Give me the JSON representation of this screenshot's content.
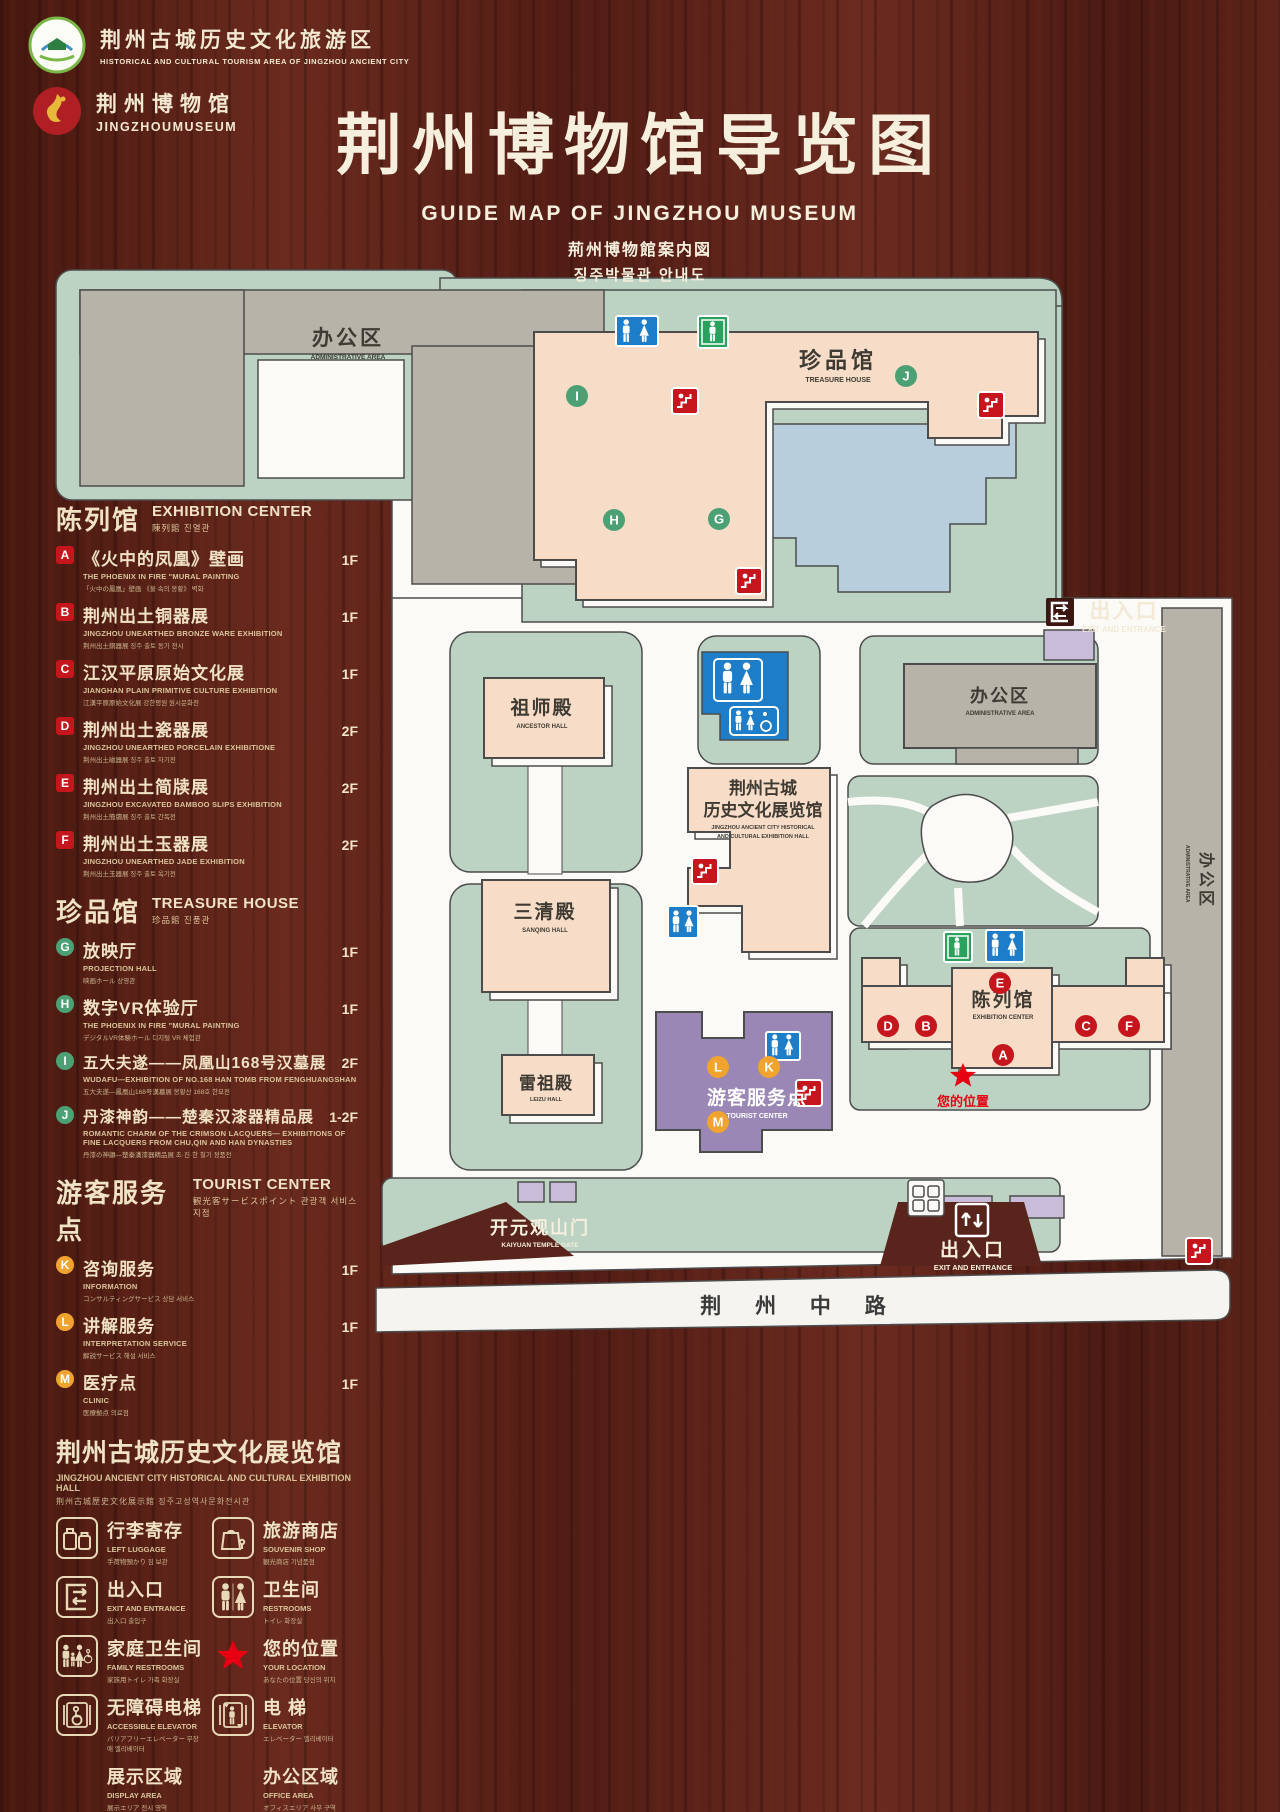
{
  "header": {
    "logo1": {
      "line1": "荆州古城历史文化旅游区",
      "line2": "HISTORICAL AND CULTURAL TOURISM AREA OF JINGZHOU ANCIENT CITY"
    },
    "logo2": {
      "line1": "荆州博物馆",
      "line2": "JINGZHOUMUSEUM"
    },
    "title": "荆州博物馆导览图",
    "subtitle_en": "GUIDE MAP OF JINGZHOU MUSEUM",
    "subtitle_ja": "荊州博物館案内図",
    "subtitle_ko": "징주박물관 안내도"
  },
  "sections": {
    "exhibition": {
      "title_zh": "陈列馆",
      "title_en": "EXHIBITION CENTER",
      "subtitle": "陳列館  진열관",
      "items": [
        {
          "key": "A",
          "zh": "《火中的凤凰》壁画",
          "en": "THE PHOENIX IN FIRE \"MURAL PAINTING",
          "sub": "「火中の鳳凰」壁画 《불 속의 봉황》 벽화",
          "floor": "1F"
        },
        {
          "key": "B",
          "zh": "荆州出土铜器展",
          "en": "JINGZHOU UNEARTHED BRONZE WARE EXHIBITION",
          "sub": "荆州出土銅器展  징주 출토 동기 전시",
          "floor": "1F"
        },
        {
          "key": "C",
          "zh": "江汉平原原始文化展",
          "en": "JIANGHAN PLAIN PRIMITIVE CULTURE EXHIBITION",
          "sub": "江漢平原原始文化展  강한평원 원시문화전",
          "floor": "1F"
        },
        {
          "key": "D",
          "zh": "荆州出土瓷器展",
          "en": "JINGZHOU UNEARTHED PORCELAIN EXHIBITIONE",
          "sub": "荆州出土磁器展  징주 출토 자기전",
          "floor": "2F"
        },
        {
          "key": "E",
          "zh": "荆州出土简牍展",
          "en": "JINGZHOU EXCAVATED BAMBOO SLIPS EXHIBITION",
          "sub": "荆州出土簡牘展  징주 출토 간독전",
          "floor": "2F"
        },
        {
          "key": "F",
          "zh": "荆州出土玉器展",
          "en": "JINGZHOU UNEARTHED JADE EXHIBITION",
          "sub": "荆州出土玉器展  징주 출토 옥기전",
          "floor": "2F"
        }
      ]
    },
    "treasure": {
      "title_zh": "珍品馆",
      "title_en": "TREASURE HOUSE",
      "subtitle": "珍品館  진품관",
      "items": [
        {
          "key": "G",
          "zh": "放映厅",
          "en": "PROJECTION HALL",
          "sub": "映画ホール  상영관",
          "floor": "1F"
        },
        {
          "key": "H",
          "zh": "数字VR体验厅",
          "en": "THE PHOENIX IN FIRE \"MURAL PAINTING",
          "sub": "デジタルVR体験ホール  디지털 VR 체험관",
          "floor": "1F"
        },
        {
          "key": "I",
          "zh": "五大夫遂——凤凰山168号汉墓展",
          "en": "WUDAFU—EXHIBITION OF NO.168 HAN TOMB FROM FENGHUANGSHAN",
          "sub": "五大夫遂—鳳凰山168号漢墓展  봉황산 168호 한묘전",
          "floor": "2F"
        },
        {
          "key": "J",
          "zh": "丹漆神韵——楚秦汉漆器精品展",
          "en": "ROMANTIC CHARM OF THE CRIMSON LACQUERS— EXHIBITIONS OF FINE LACQUERS FROM CHU,QIN AND HAN DYNASTIES",
          "sub": "丹漆の神韻—楚秦漢漆器精品展  초·진·한 칠기 정품전",
          "floor": "1-2F"
        }
      ]
    },
    "tourist": {
      "title_zh": "游客服务点",
      "title_en": "TOURIST CENTER",
      "subtitle": "観光客サービスポイント  관광객 서비스 지점",
      "items": [
        {
          "key": "K",
          "zh": "咨询服务",
          "en": "INFORMATION",
          "sub": "コンサルティングサービス  상담 서비스",
          "floor": "1F"
        },
        {
          "key": "L",
          "zh": "讲解服务",
          "en": "INTERPRETATION SERVICE",
          "sub": "解説サービス  해설 서비스",
          "floor": "1F"
        },
        {
          "key": "M",
          "zh": "医疗点",
          "en": "CLINIC",
          "sub": "医療拠点  의료점",
          "floor": "1F"
        }
      ]
    },
    "hall_note": {
      "zh": "荆州古城历史文化展览馆",
      "en": "JINGZHOU ANCIENT CITY HISTORICAL AND CULTURAL EXHIBITION HALL",
      "sub": "荆州古城歴史文化展示館  징주고성역사문화전시관"
    }
  },
  "legend": [
    {
      "zh": "行李寄存",
      "en": "LEFT LUGGAGE",
      "sub": "手荷物預かり  짐 보관"
    },
    {
      "zh": "旅游商店",
      "en": "SOUVENIR SHOP",
      "sub": "観光商店  기념품점"
    },
    {
      "zh": "出入口",
      "en": "EXIT AND ENTRANCE",
      "sub": "出入口  출입구"
    },
    {
      "zh": "卫生间",
      "en": "RESTROOMS",
      "sub": "トイレ  화장실"
    },
    {
      "zh": "家庭卫生间",
      "en": "FAMILY RESTROOMS",
      "sub": "家族用トイレ  가족 화장실"
    },
    {
      "zh": "您的位置",
      "en": "YOUR LOCATION",
      "sub": "あなたの位置  당신의 위치"
    },
    {
      "zh": "无障碍电梯",
      "en": "ACCESSIBLE ELEVATOR",
      "sub": "バリアフリーエレベーター  무장애 엘리베이터"
    },
    {
      "zh": "电  梯",
      "en": "ELEVATOR",
      "sub": "エレベーター  엘리베이터"
    },
    {
      "zh": "展示区域",
      "en": "DISPLAY AREA",
      "sub": "展示エリア  전시 영역"
    },
    {
      "zh": "办公区域",
      "en": "OFFICE AREA",
      "sub": "オフィスエリア  사무 구역"
    }
  ],
  "map": {
    "labels": {
      "admin_top": "办公区",
      "admin_top_en": "ADMINISTRATIVE AREA",
      "treasure": "珍品馆",
      "treasure_en": "TREASURE HOUSE",
      "exit_right": "出入口",
      "exit_right_en": "EXIT AND ENTRANCE",
      "admin_right": "办公区",
      "admin_right_en": "ADMINISTRATIVE AREA",
      "admin_strip": "办公区",
      "admin_strip_en": "ADMINISTRATIVE AREA",
      "ancestor": "祖师殿",
      "ancestor_en": "ANCESTOR HALL",
      "hall1": "荆州古城",
      "hall2": "历史文化展览馆",
      "hall_en1": "JINGZHOU ANCIENT CITY HISTORICAL",
      "hall_en2": "AND CULTURAL EXHIBITION HALL",
      "sanqing": "三清殿",
      "sanqing_en": "SANQING HALL",
      "leizu": "雷祖殿",
      "leizu_en": "LEIZU HALL",
      "tourist": "游客服务点",
      "tourist_en": "TOURIST CENTER",
      "exhibition": "陈列馆",
      "exhibition_en": "EXHIBITION CENTER",
      "location": "您的位置",
      "gate": "开元观山门",
      "gate_en": "KAIYUAN TEMPLE GATE",
      "exit_bottom": "出入口",
      "exit_bottom_en": "EXIT AND ENTRANCE",
      "road": "荆 州 中 路"
    },
    "markers": {
      "treasure": [
        "I",
        "H",
        "G",
        "J"
      ],
      "exhibition": [
        "E",
        "A",
        "D",
        "B",
        "C",
        "F"
      ],
      "tourist": [
        "L",
        "K",
        "M"
      ]
    },
    "colors": {
      "display": "#f7dcc8",
      "office": "#b7b3a8",
      "green": "#bcd2c3",
      "lake": "#b9cedc",
      "purple": "#9b87b5",
      "purple_light": "#c9bcd9",
      "road": "#f6f4ee",
      "badge_red": "#c5161d",
      "badge_green": "#4ba173",
      "badge_orange": "#f0a32f",
      "restroom_blue": "#1e7dc8",
      "elevator_green": "#2aa15c",
      "star_red": "#e60012"
    }
  }
}
